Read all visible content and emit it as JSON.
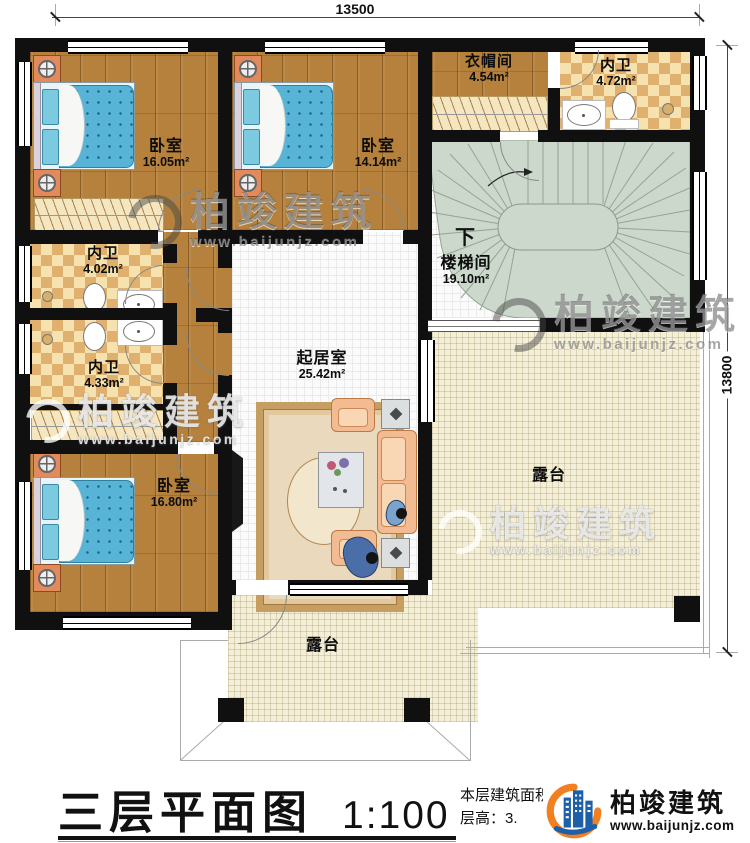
{
  "dimensions": {
    "width_top": "13500",
    "height_right": "13800"
  },
  "rooms": [
    {
      "name": "卧室",
      "area": "16.05m²"
    },
    {
      "name": "卧室",
      "area": "14.14m²"
    },
    {
      "name": "衣帽间",
      "area": "4.54m²"
    },
    {
      "name": "内卫",
      "area": "4.72m²"
    },
    {
      "name": "内卫",
      "area": "4.02m²"
    },
    {
      "name": "内卫",
      "area": "4.33m²"
    },
    {
      "name": "卧室",
      "area": "16.80m²"
    },
    {
      "name": "楼梯间",
      "area": "19.10m²"
    },
    {
      "name": "起居室",
      "area": "25.42m²"
    },
    {
      "name": "露台"
    },
    {
      "name": "露台"
    }
  ],
  "stairs": {
    "direction_label": "下"
  },
  "title_block": {
    "drawing_title": "三层平面图",
    "scale": "1:100",
    "floor_area_text": "本层建筑面积：",
    "floor_height_text": "层高：3."
  },
  "watermark": {
    "brand": "柏竣建筑",
    "site": "www.baijunjz.com"
  },
  "logo": {
    "brand": "柏竣建筑",
    "site": "www.baijunjz.com"
  },
  "colors": {
    "wall": "#101010",
    "wood": "#b5813c",
    "tile": "#e0b06f",
    "stair": "#ccd8cb",
    "terrace": "#f4efd8",
    "bed": "#58b4d6",
    "logo_blue": "#1d5fa8",
    "logo_orange": "#f28020"
  }
}
